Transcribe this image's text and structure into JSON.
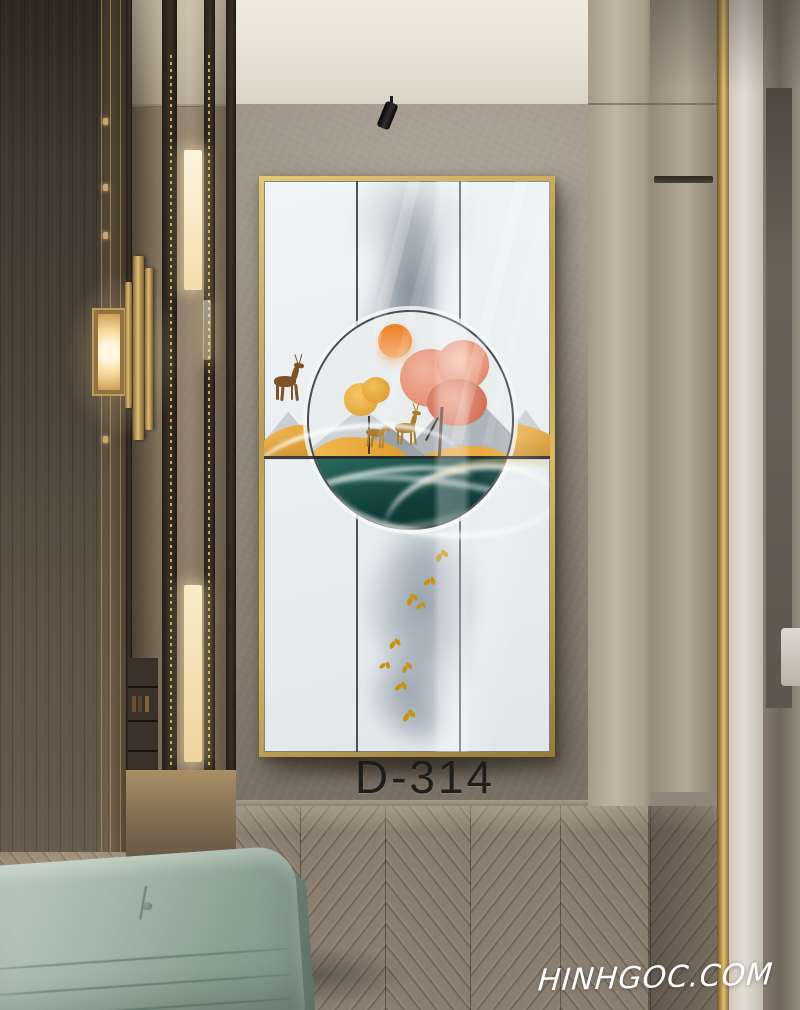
{
  "photo": {
    "product_code": "D-314",
    "watermark": "HINHGOC.COM"
  },
  "artwork": {
    "subject": "abstract landscape circle with sun, autumn trees, deer, golden hills, teal lake, ink smoke and gold birds",
    "frame_color": "#c2a251"
  },
  "palette": {
    "frame_gold": "#c2a251",
    "wall_taupe": "#95897b",
    "ceiling_cream": "#e6e1d4",
    "left_wall_brown": "#4c4338",
    "bench_sage": "#9bafa0",
    "floor_wood": "#8a7e70",
    "art_teal": "#123f3a",
    "art_amber": "#e8a93f",
    "art_coral": "#dd8064",
    "art_sun_orange": "#ed8b33",
    "bird_gold": "#c8920f",
    "gold_trim": "#c3a055",
    "label_black": "#20201e",
    "watermark_white": "#ffffff"
  }
}
